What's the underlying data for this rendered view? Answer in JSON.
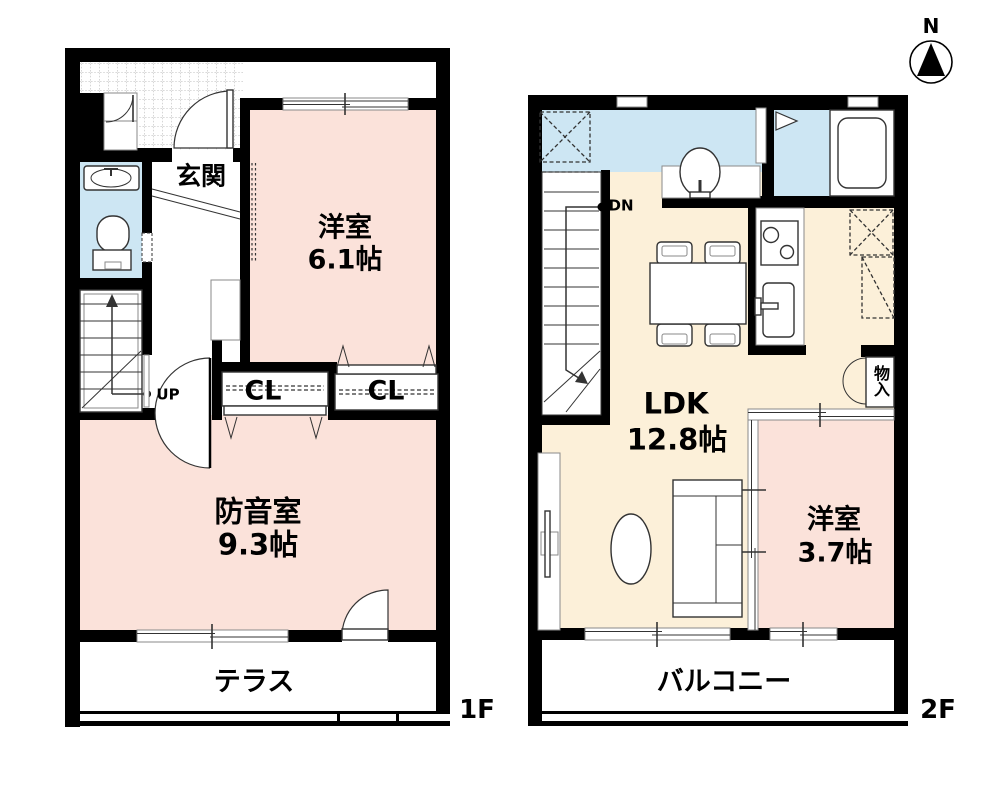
{
  "compass": {
    "label": "N"
  },
  "floor1": {
    "floor_label": "1F",
    "entrance_label": "玄関",
    "western_room_label": "洋室",
    "western_room_size": "6.1帖",
    "closet_left_label": "CL",
    "closet_right_label": "CL",
    "soundproof_room_label": "防音室",
    "soundproof_room_size": "9.3帖",
    "terrace_label": "テラス",
    "stairs_label": "UP"
  },
  "floor2": {
    "floor_label": "2F",
    "ldk_label": "LDK",
    "ldk_size": "12.8帖",
    "western_room_label": "洋室",
    "western_room_size": "3.7帖",
    "storage_label": "物入",
    "balcony_label": "バルコニー",
    "stairs_label": "DN"
  },
  "colors": {
    "bg": "#ffffff",
    "wall": "#000000",
    "room_pink": "#fbe2da",
    "room_beige": "#fcf0d9",
    "room_blue": "#cde6f3",
    "line": "#333333",
    "line_soft": "#8a8a8a",
    "tile_grid": "#9a9a9a"
  }
}
